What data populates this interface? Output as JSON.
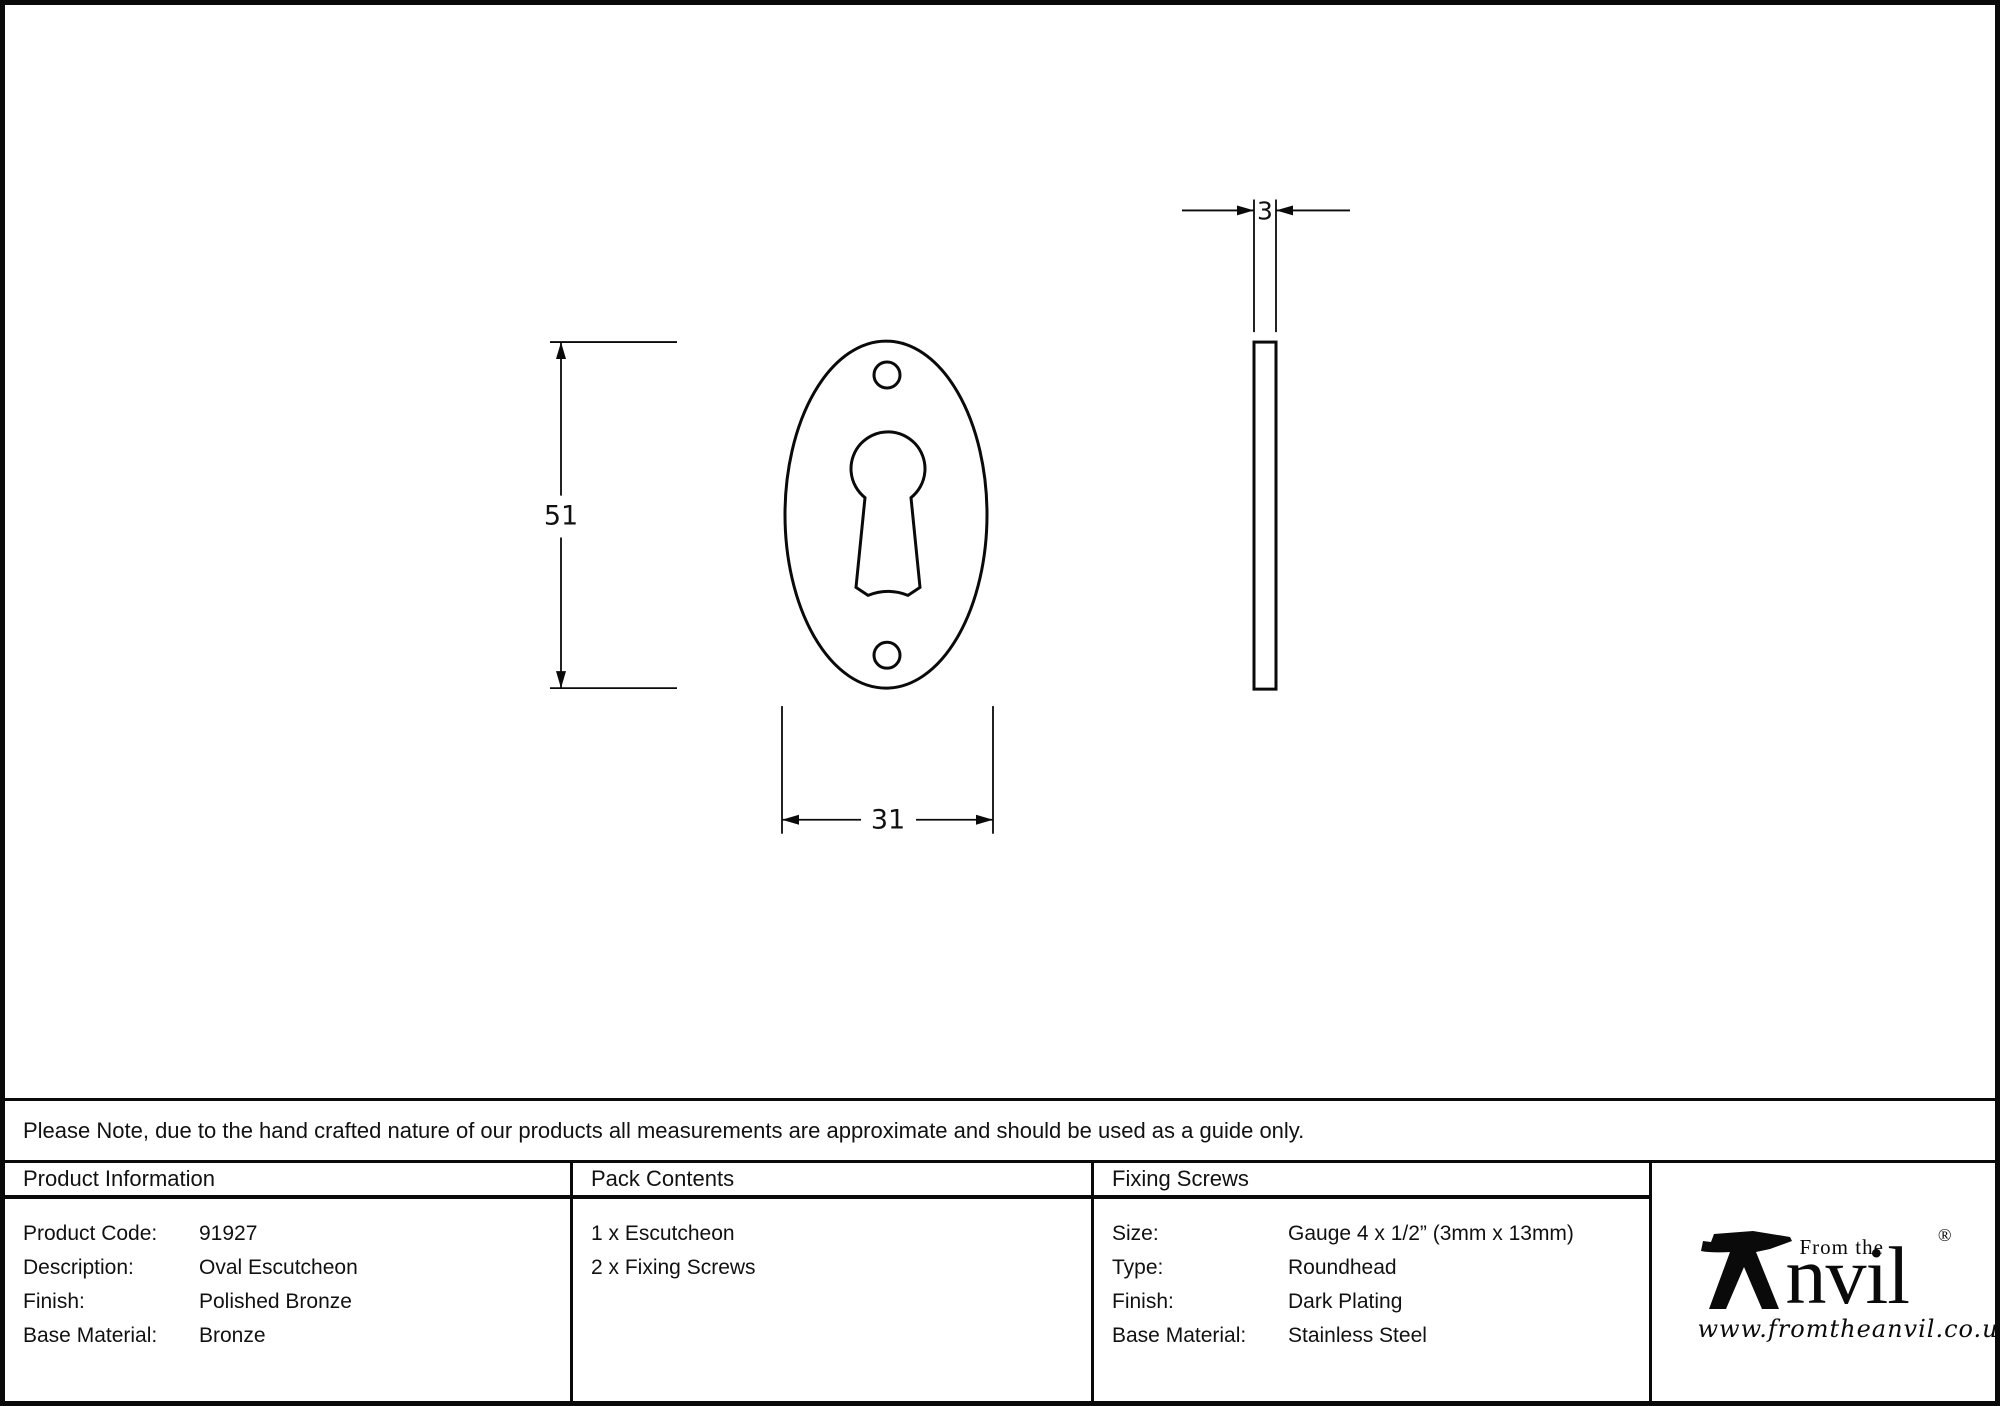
{
  "colors": {
    "ink": "#0a0a0a",
    "paper": "#ffffff"
  },
  "drawing": {
    "front_view": {
      "name": "oval escutcheon front view",
      "height_dim": "51",
      "width_dim": "31"
    },
    "side_view": {
      "name": "escutcheon side profile",
      "thickness_dim": "3"
    }
  },
  "note": {
    "text": "Please Note, due to the hand crafted nature of our products all measurements are approximate and should be used as a guide only."
  },
  "table": {
    "product_information": {
      "header": "Product Information",
      "rows": [
        {
          "label": "Product Code:",
          "value": "91927"
        },
        {
          "label": "Description:",
          "value": "Oval Escutcheon"
        },
        {
          "label": "Finish:",
          "value": "Polished Bronze"
        },
        {
          "label": "Base Material:",
          "value": "Bronze"
        }
      ]
    },
    "pack_contents": {
      "header": "Pack Contents",
      "items": [
        "1 x Escutcheon",
        "2 x Fixing Screws"
      ]
    },
    "fixing_screws": {
      "header": "Fixing Screws",
      "rows": [
        {
          "label": "Size:",
          "value": "Gauge 4 x 1/2” (3mm x 13mm)"
        },
        {
          "label": "Type:",
          "value": "Roundhead"
        },
        {
          "label": "Finish:",
          "value": "Dark Plating"
        },
        {
          "label": "Base Material:",
          "value": "Stainless Steel"
        }
      ]
    }
  },
  "logo": {
    "brand_prefix": "From the",
    "brand_suffix": "nvil",
    "registered_mark": "®",
    "website": "www.fromtheanvil.co.uk"
  }
}
